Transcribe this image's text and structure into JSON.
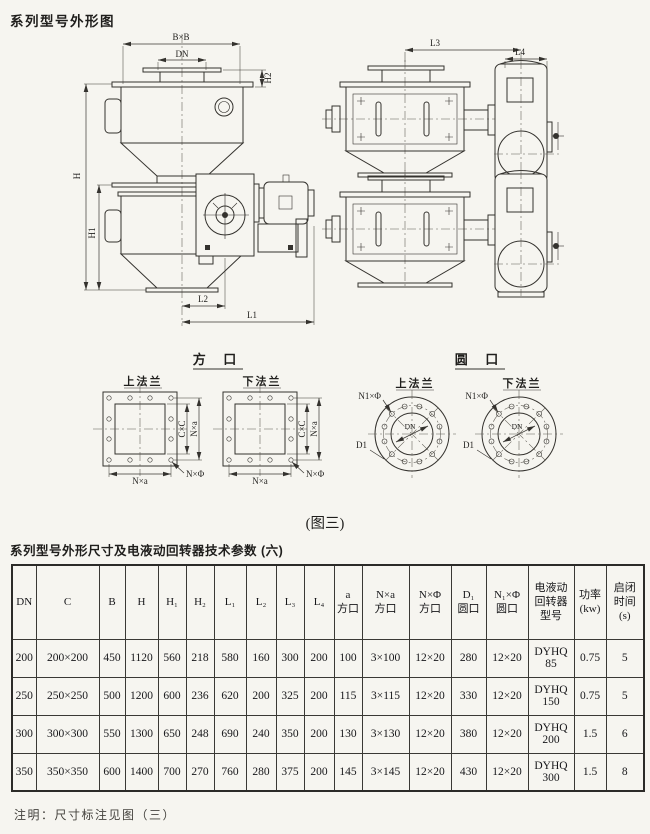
{
  "page": {
    "title": "系列型号外形图",
    "figure_caption": "(图三)",
    "table_title": "系列型号外形尺寸及电液动回转器技术参数 (六)",
    "note": "注明：尺寸标注见图（三）",
    "paper_color": "#f6f5f0",
    "ink_color": "#34322e"
  },
  "drawing": {
    "front_view": {
      "dim_bxb": "B×B",
      "dim_dn": "DN",
      "dim_h2": "H2",
      "dim_h": "H",
      "dim_h1": "H1",
      "dim_l2": "L2",
      "dim_l1": "L1"
    },
    "side_view": {
      "dim_l3": "L3",
      "dim_l4": "L4"
    },
    "square_port": {
      "title": "方 口",
      "upper_flange_label": "上法兰",
      "lower_flange_label": "下法兰",
      "dim_cxc": "C×C",
      "dim_nxa_vertical": "N×a",
      "dim_nxa_bottom": "N×a",
      "dim_nxphi": "N×Φ"
    },
    "round_port": {
      "title": "圆 口",
      "upper_flange_label": "上法兰",
      "lower_flange_label": "下法兰",
      "dim_n1xphi": "N1×Φ",
      "dim_dn": "DN",
      "dim_d1": "D1"
    }
  },
  "table": {
    "headers": [
      "DN",
      "C",
      "B",
      "H",
      "H₁",
      "H₂",
      "L₁",
      "L₂",
      "L₃",
      "L₄",
      "a\n方口",
      "N×a\n方口",
      "N×Φ\n方口",
      "D₁\n圆口",
      "N₁×Φ\n圆口",
      "电液动\n回转器\n型号",
      "功率\n(kw)",
      "启闭\n时间\n(s)"
    ],
    "rows": [
      [
        "200",
        "200×200",
        "450",
        "1120",
        "560",
        "218",
        "580",
        "160",
        "300",
        "200",
        "100",
        "3×100",
        "12×20",
        "280",
        "12×20",
        "DYHQ\n85",
        "0.75",
        "5"
      ],
      [
        "250",
        "250×250",
        "500",
        "1200",
        "600",
        "236",
        "620",
        "200",
        "325",
        "200",
        "115",
        "3×115",
        "12×20",
        "330",
        "12×20",
        "DYHQ\n150",
        "0.75",
        "5"
      ],
      [
        "300",
        "300×300",
        "550",
        "1300",
        "650",
        "248",
        "690",
        "240",
        "350",
        "200",
        "130",
        "3×130",
        "12×20",
        "380",
        "12×20",
        "DYHQ\n200",
        "1.5",
        "6"
      ],
      [
        "350",
        "350×350",
        "600",
        "1400",
        "700",
        "270",
        "760",
        "280",
        "375",
        "200",
        "145",
        "3×145",
        "12×20",
        "430",
        "12×20",
        "DYHQ\n300",
        "1.5",
        "8"
      ]
    ]
  }
}
